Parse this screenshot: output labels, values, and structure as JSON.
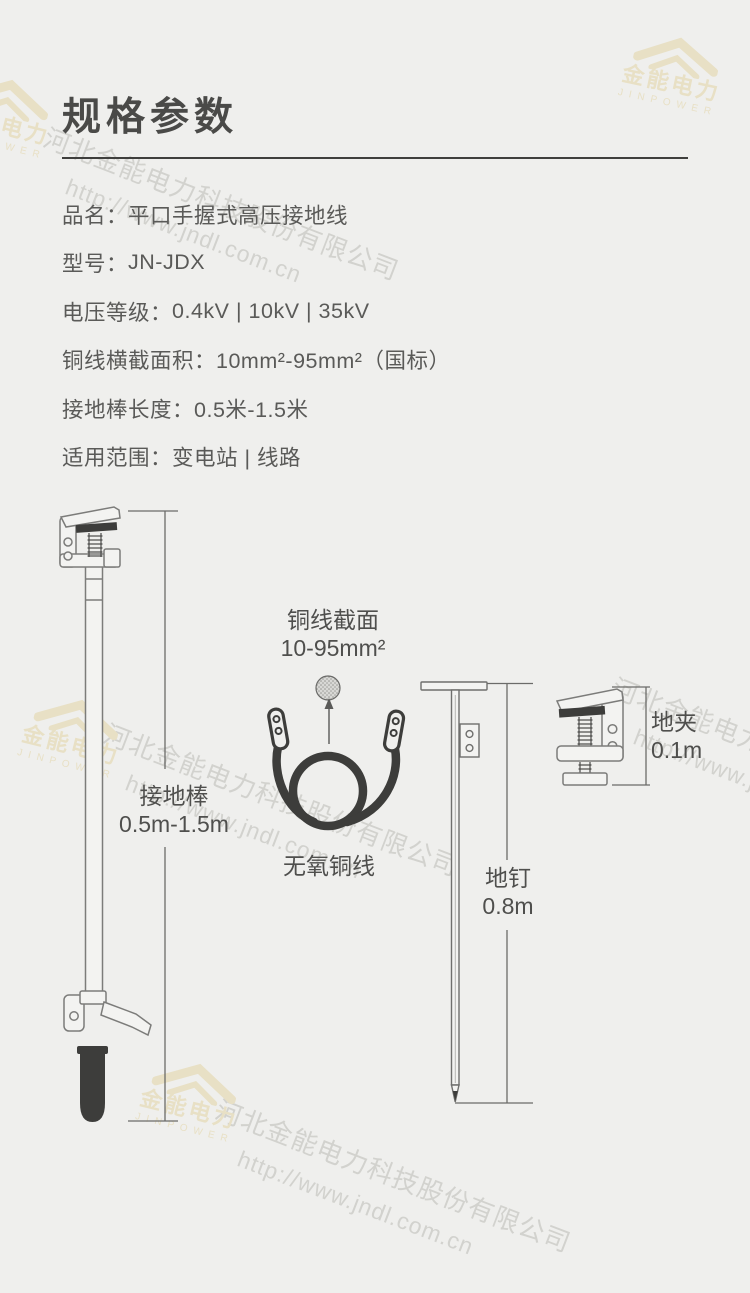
{
  "page": {
    "title": "规格参数"
  },
  "specs": [
    {
      "label": "品名：",
      "value": "平口手握式高压接地线"
    },
    {
      "label": "型号：",
      "value": "JN-JDX"
    },
    {
      "label": "电压等级：",
      "value": "0.4kV | 10kV | 35kV"
    },
    {
      "label": "铜线横截面积：",
      "value": "10mm²-95mm²（国标）"
    },
    {
      "label": "接地棒长度：",
      "value": "0.5米-1.5米"
    },
    {
      "label": "适用范围：",
      "value": "变电站 | 线路"
    }
  ],
  "diagram": {
    "rod": {
      "label": "接地棒",
      "dimension": "0.5m-1.5m"
    },
    "wire": {
      "section_label": "铜线截面",
      "section_value": "10-95mm²",
      "name": "无氧铜线"
    },
    "nail": {
      "label": "地钉",
      "dimension": "0.8m"
    },
    "clamp": {
      "label": "地夹",
      "dimension": "0.1m"
    }
  },
  "watermark": {
    "logo_cn": "金能电力",
    "logo_en": "JINPOWER",
    "company": "河北金能电力科技股份有限公司",
    "url": "http://www.jndl.com.cn"
  },
  "colors": {
    "background": "#EFEFED",
    "title_text": "#4A4A48",
    "body_text": "#5A5A58",
    "line_dark": "#3D3D3B",
    "outline": "#7C7C7A",
    "watermark_beige": "#E8E0C5",
    "watermark_gray": "#D2D2CE"
  }
}
